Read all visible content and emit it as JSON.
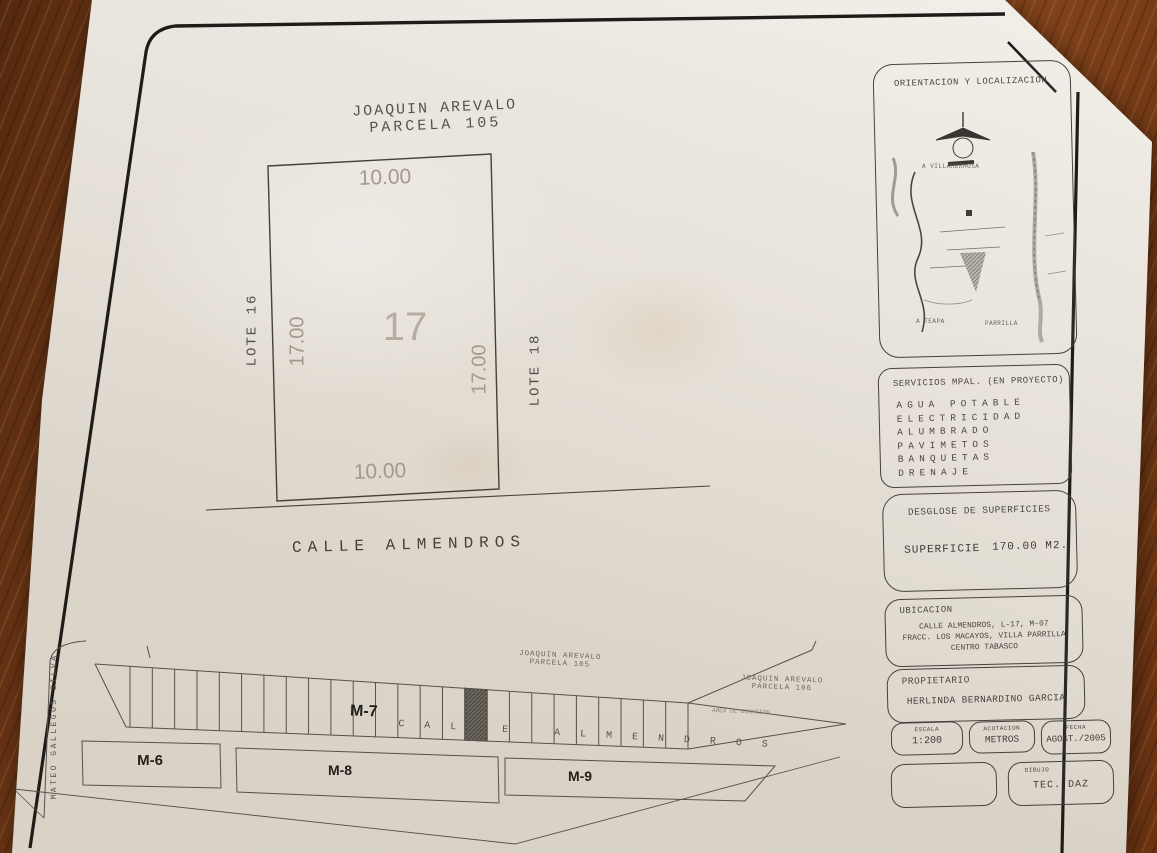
{
  "sheet": {
    "header": {
      "line1": "JOAQUIN AREVALO",
      "line2": "PARCELA 105"
    },
    "main_lot": {
      "number": "17",
      "dim_top": "10.00",
      "dim_bottom": "10.00",
      "dim_left": "17.00",
      "dim_right": "17.00",
      "neighbor_left": "LOTE 16",
      "neighbor_right": "LOTE 18",
      "street": "CALLE ALMENDROS"
    },
    "strip_plan": {
      "street_left": "MATEO GALLEGOS SILVA",
      "street": "CALLE ALMENDROS",
      "parcel_above_line1": "JOAQUIN AREVALO",
      "parcel_above_line2": "PARCELA 105",
      "parcel_right_line1": "JOAQUIN AREVALO",
      "parcel_right_line2": "PARCELA 106",
      "block_m6": "M-6",
      "block_m7": "M-7",
      "block_m8": "M-8",
      "block_m9": "M-9",
      "annotation": "AREA DE DONACION",
      "lot_count": 25,
      "highlight_lot_index": 15
    },
    "panels": {
      "orientation": {
        "title": "ORIENTACION Y LOCALIZACION",
        "map_labels": {
          "nw": "A VILLAHERMOSA",
          "sw": "A TEAPA",
          "se": "PARRILLA"
        }
      },
      "services": {
        "title": "SERVICIOS MPAL. (EN PROYECTO)",
        "items": [
          "AGUA POTABLE",
          "ELECTRICIDAD",
          "ALUMBRADO",
          "PAVIMETOS",
          "BANQUETAS",
          "DRENAJE"
        ]
      },
      "surfaces": {
        "title": "DESGLOSE DE SUPERFICIES",
        "label": "SUPERFICIE",
        "value": "170.00 M2."
      },
      "location": {
        "title": "UBICACION",
        "lines": [
          "CALLE ALMENDROS, L-17, M-07",
          "FRACC. LOS MACAYOS, VILLA PARRILLA",
          "CENTRO TABASCO"
        ]
      },
      "owner": {
        "title": "PROPIETARIO",
        "name": "HERLINDA BERNARDINO GARCIA"
      },
      "scale": {
        "label": "ESCALA",
        "value": "1:200"
      },
      "units": {
        "label": "ACOTACION",
        "value": "METROS"
      },
      "date": {
        "label": "FECHA",
        "value": "AGOST./2005"
      },
      "drawing": {
        "label": "DIBUJO",
        "value": "TEC. DAZ"
      }
    },
    "colors": {
      "ink": "#3e3a34",
      "dim_gray": "#9a9287",
      "paper": "#eae5dc",
      "highlight_lot": "#6b675f"
    }
  }
}
